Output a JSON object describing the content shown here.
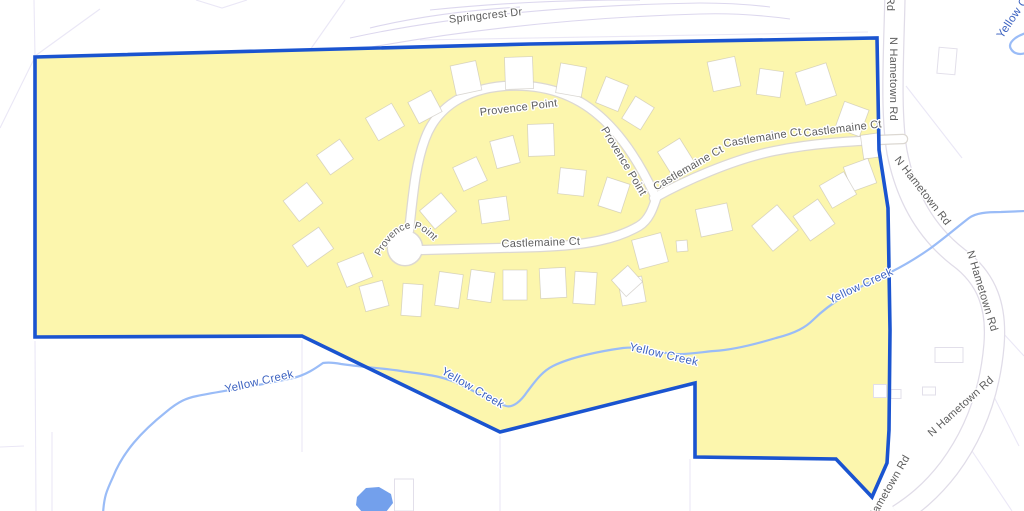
{
  "map": {
    "colors": {
      "background": "#ffffff",
      "region_fill": "#FCF6AD",
      "region_stroke": "#1A54D0",
      "creek_stroke": "#9ABCF7",
      "pond_fill": "#73A0EC",
      "water_label": "#3D63C1",
      "road_label": "#5D5D5D",
      "road_fill": "#FFFFFF",
      "road_casing": "#DCD8D2",
      "hametown_casing": "#E0DCE8",
      "parcel_line": "#EAE7F6",
      "springcrest_line": "#DCD7EE",
      "building_fill": "#FFFFFF"
    },
    "boundary_points": "35,57 530,44 877,38 879,150 888,208 890,330 889,430 887,463 872,497 836,459 695,457 695,383 500,432 302,336 35,337",
    "creek_main": "M 103,514 C 104,496 107,490 113,477 C 123,452 141,432 166,412 C 179,401 187,398 197,396 C 216,392 252,387 293,378 C 306,375 316,368 323,363 C 330,362 336,363 341,364 C 362,367 381,368 401,371 C 421,374 441,375 459,384 C 472,390 492,401 506,406 C 513,408 521,401 527,392 C 534,383 541,372 553,366 C 571,357 601,351 623,348 C 641,346 651,351 666,353 C 681,356 701,352 714,351 C 731,350 756,344 776,338 C 796,333 806,327 813,320 C 821,312 831,304 846,295 C 861,286 876,279 891,272 C 903,266 915,259 928,250 C 941,241 956,228 969,218 C 976,213 986,212 1001,212 L 1026,211",
    "creek_ne": "M 1026,33 C 1016,36 1007,43 1011,49 C 1014,54 1020,55 1026,53",
    "pond_points": "357,497 366,488 379,487 391,494 393,503 386,512 362,512 356,505",
    "hametown_path": "M 895,-6 C 894,50 890,110 897,152 C 906,198 926,232 958,257 C 988,279 997,308 994,345 C 990,392 975,433 949,468 C 930,493 912,506 898,515",
    "local_roads": [
      "M 409,231 C 413,196 415,166 425,139 C 437,106 467,89 504,86 C 546,83 579,96 604,120 C 627,142 644,172 655,196",
      "M 422,250 L 540,247 C 588,245 617,239 639,226 C 649,220 653,208 656,199",
      "M 654,198 C 684,181 734,159 774,151 C 814,143 850,141 903,139"
    ],
    "culdesac": {
      "cx": 405,
      "cy": 248,
      "r": 17
    },
    "springcrest_arcs": [
      "M 350,38 C 460,14 580,5 700,3 C 720,3 745,4 770,7",
      "M 345,52 C 470,28 590,17 700,14 C 730,13 760,15 790,19",
      "M 430,10 C 500,3 560,0 640,0",
      "M 370,28 C 420,16 470,10 520,7"
    ],
    "parcel_lines": [
      "0,128 35,57",
      "35,56 100,9",
      "34,0 35,57",
      "196,0 222,8 247,0",
      "310,50 345,0",
      "420,40 868,32",
      "35,341 36,511",
      "52,432 52,511",
      "0,447 24,446",
      "302,340 302,452",
      "500,436 500,511",
      "690,459 690,511",
      "906,86 962,158",
      "990,389 1019,446",
      "962,436 1012,511",
      "1002,332 1024,356"
    ],
    "buildings": [
      [
        303,
        202,
        30,
        26,
        -38
      ],
      [
        335,
        157,
        28,
        24,
        -35
      ],
      [
        313,
        247,
        32,
        26,
        -35
      ],
      [
        355,
        270,
        28,
        26,
        -22
      ],
      [
        385,
        122,
        30,
        26,
        -30
      ],
      [
        425,
        107,
        26,
        24,
        -28
      ],
      [
        466,
        78,
        26,
        30,
        -12
      ],
      [
        519,
        73,
        28,
        32,
        -2
      ],
      [
        571,
        80,
        26,
        30,
        10
      ],
      [
        612,
        94,
        24,
        28,
        22
      ],
      [
        638,
        113,
        22,
        26,
        32
      ],
      [
        724,
        74,
        28,
        30,
        -12
      ],
      [
        770,
        83,
        24,
        26,
        8
      ],
      [
        816,
        84,
        32,
        34,
        -18
      ],
      [
        852,
        119,
        26,
        28,
        20
      ],
      [
        871,
        146,
        18,
        24,
        -8
      ],
      [
        676,
        157,
        26,
        28,
        -32
      ],
      [
        860,
        175,
        26,
        26,
        -20
      ],
      [
        838,
        190,
        28,
        26,
        -30
      ],
      [
        814,
        220,
        30,
        30,
        -35
      ],
      [
        775,
        228,
        33,
        33,
        -40
      ],
      [
        714,
        220,
        32,
        28,
        -12
      ],
      [
        682,
        246,
        11,
        11,
        -5
      ],
      [
        650,
        251,
        30,
        30,
        -15
      ],
      [
        632,
        291,
        24,
        26,
        -10
      ],
      [
        438,
        211,
        28,
        24,
        -40
      ],
      [
        494,
        210,
        28,
        24,
        -8
      ],
      [
        470,
        174,
        26,
        26,
        -25
      ],
      [
        505,
        152,
        24,
        28,
        -15
      ],
      [
        541,
        140,
        26,
        32,
        -2
      ],
      [
        572,
        182,
        26,
        26,
        6
      ],
      [
        614,
        195,
        24,
        30,
        18
      ],
      [
        374,
        296,
        24,
        26,
        -15
      ],
      [
        412,
        300,
        20,
        32,
        4
      ],
      [
        449,
        290,
        24,
        34,
        8
      ],
      [
        481,
        286,
        24,
        30,
        8
      ],
      [
        515,
        285,
        24,
        30,
        0
      ],
      [
        553,
        283,
        26,
        30,
        -3
      ],
      [
        585,
        288,
        22,
        32,
        4
      ],
      [
        627,
        281,
        22,
        22,
        -42
      ]
    ],
    "outside_buildings": [
      [
        947,
        61,
        18,
        26,
        5
      ],
      [
        949,
        355,
        28,
        15,
        0
      ],
      [
        880,
        391,
        13,
        13,
        0
      ],
      [
        896,
        394,
        10,
        9,
        0
      ],
      [
        929,
        391,
        13,
        8,
        0
      ],
      [
        404,
        495,
        19,
        32,
        0
      ]
    ],
    "labels": [
      {
        "text": "Springcrest Dr",
        "x": 486,
        "y": 19,
        "rot": -6,
        "kind": "road"
      },
      {
        "text": "Provence Point",
        "x": 519,
        "y": 111,
        "rot": -7,
        "kind": "road"
      },
      {
        "text": "Provence Point",
        "x": 621,
        "y": 163,
        "rot": 59,
        "kind": "road"
      },
      {
        "text": "Provence Point",
        "kind": "road-arc",
        "path": "M 378,260 Q 406,206 436,244"
      },
      {
        "text": "Castlemaine Ct",
        "x": 541,
        "y": 246,
        "rot": -2,
        "kind": "road"
      },
      {
        "text": "Castlemaine Ct",
        "x": 690,
        "y": 171,
        "rot": -30,
        "kind": "road"
      },
      {
        "text": "Castlemaine Ct",
        "x": 763,
        "y": 141,
        "rot": -9,
        "kind": "road"
      },
      {
        "text": "Castlemaine Ct",
        "x": 843,
        "y": 132,
        "rot": -7,
        "kind": "road"
      },
      {
        "text": "N Hametown Rd",
        "x": 890,
        "y": 79,
        "rot": 90,
        "kind": "road"
      },
      {
        "text": "N Hametown Rd",
        "x": 920,
        "y": 193,
        "rot": 52,
        "kind": "road"
      },
      {
        "text": "N Hametown Rd",
        "x": 979,
        "y": 292,
        "rot": 73,
        "kind": "road"
      },
      {
        "text": "N Hametown Rd",
        "x": 963,
        "y": 409,
        "rot": -42,
        "kind": "road"
      },
      {
        "text": "N Hametown Rd",
        "x": 889,
        "y": 494,
        "rot": -60,
        "kind": "road"
      },
      {
        "text": "Rd",
        "x": 887,
        "y": 4,
        "rot": 90,
        "kind": "road"
      },
      {
        "text": "Yellow Creek",
        "x": 260,
        "y": 385,
        "rot": -13,
        "kind": "water"
      },
      {
        "text": "Yellow Creek",
        "x": 471,
        "y": 391,
        "rot": 30,
        "kind": "water"
      },
      {
        "text": "Yellow Creek",
        "x": 663,
        "y": 358,
        "rot": 13,
        "kind": "water"
      },
      {
        "text": "Yellow Creek",
        "x": 862,
        "y": 289,
        "rot": -25,
        "kind": "water"
      },
      {
        "text": "Yellow Creek",
        "x": 1022,
        "y": 10,
        "rot": -56,
        "kind": "water"
      }
    ]
  }
}
